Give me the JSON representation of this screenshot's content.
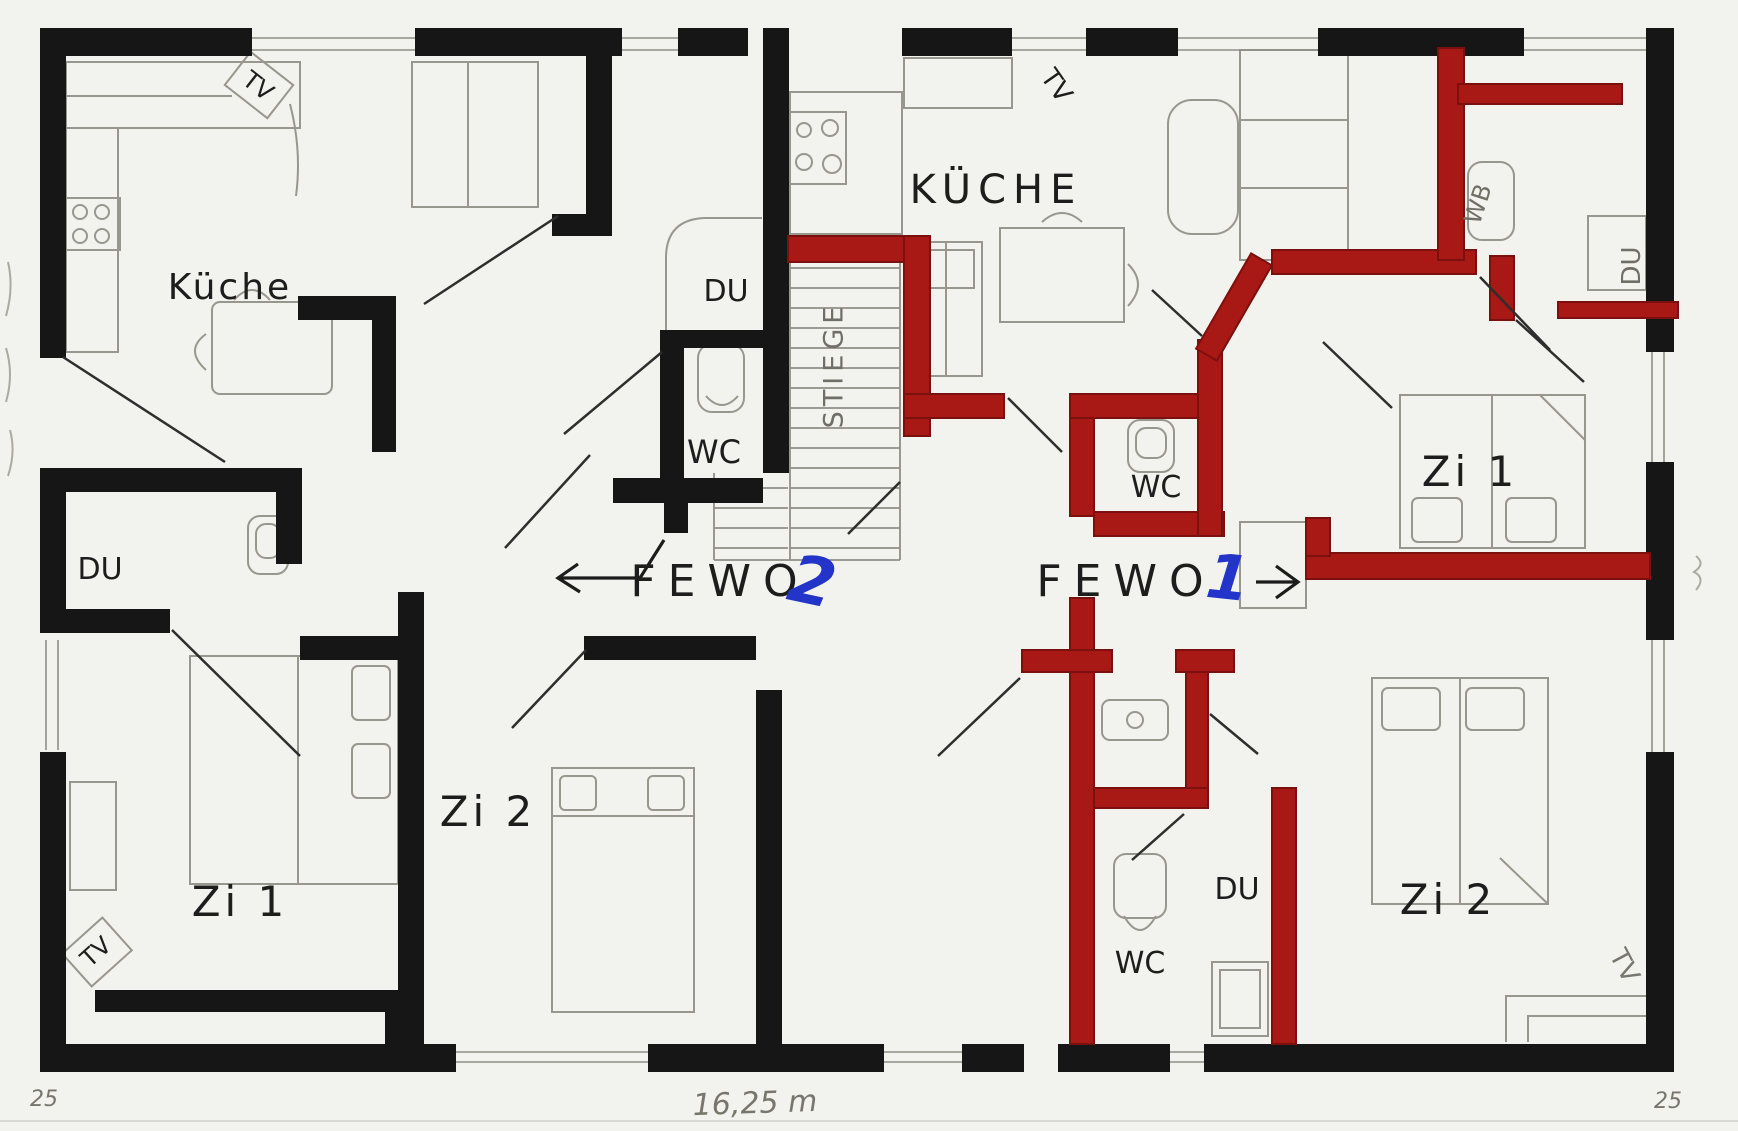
{
  "colors": {
    "wall_black": "#161616",
    "wall_red": "#a81814",
    "ink_blue": "#2334c8",
    "pencil_gray": "#97978d",
    "paper": "#f2f2ee"
  },
  "apartments": {
    "fewo2": {
      "name": "FEWO",
      "number": "2",
      "arrow_direction": "left"
    },
    "fewo1": {
      "name": "FEWO",
      "number": "1",
      "arrow_direction": "right"
    }
  },
  "rooms": {
    "fewo2_kitchen": "Küche",
    "fewo1_kitchen": "KÜCHE",
    "fewo2_shower_hall": "DU",
    "fewo2_wc": "WC",
    "fewo2_shower_left": "DU",
    "fewo2_room1": "Zi 1",
    "fewo2_room2": "Zi 2",
    "fewo1_wc_top": "WC",
    "fewo1_washbasin": "WB",
    "fewo1_shower_top": "DU",
    "fewo1_room1": "Zi 1",
    "fewo1_room2": "Zi 2",
    "fewo1_shower_bottom": "DU",
    "fewo1_wc_bottom": "WC",
    "staircase": "STIEGE"
  },
  "fixtures": {
    "tv": "TV"
  },
  "annotations": {
    "width_dimension": "16,25 m",
    "sheet_left": "25",
    "sheet_right": "25"
  }
}
